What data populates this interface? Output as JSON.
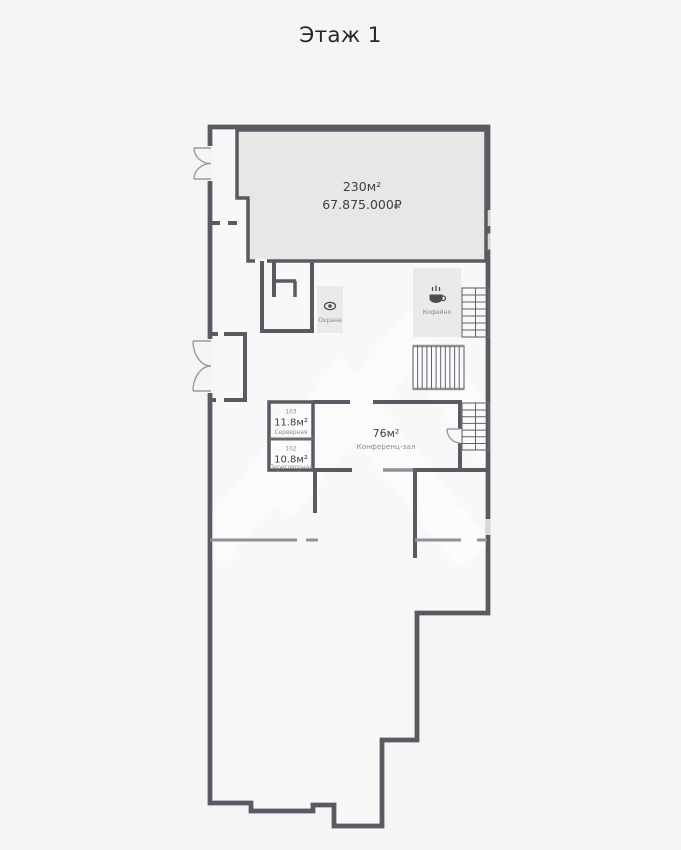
{
  "title": "Этаж 1",
  "colors": {
    "page_bg": "#f5f5f6",
    "plan_bg": "#f8f8f8",
    "wall_dark": "#5a5a63",
    "wall_mid": "#90909a",
    "highlight_room_fill": "#e7e7e5",
    "zone_fill": "#eaeae9",
    "window": "#d8d8d6",
    "text_dark": "#3e3e48",
    "text_muted": "#8b8b91",
    "watermark": "#ffffff"
  },
  "highlight_room": {
    "area": "230м²",
    "price": "67.875.000₽"
  },
  "rooms": {
    "server": {
      "number": "103",
      "area": "11.8м²",
      "name": "Серверная"
    },
    "meeting": {
      "number": "102",
      "area": "10.8м²",
      "name": "Переговорная"
    },
    "conference": {
      "area": "76м²",
      "name": "Конференц-зал"
    }
  },
  "zones": {
    "security": {
      "name": "Охрана",
      "icon": "eye-icon"
    },
    "coffee": {
      "name": "Кофейня",
      "icon": "coffee-icon"
    }
  }
}
